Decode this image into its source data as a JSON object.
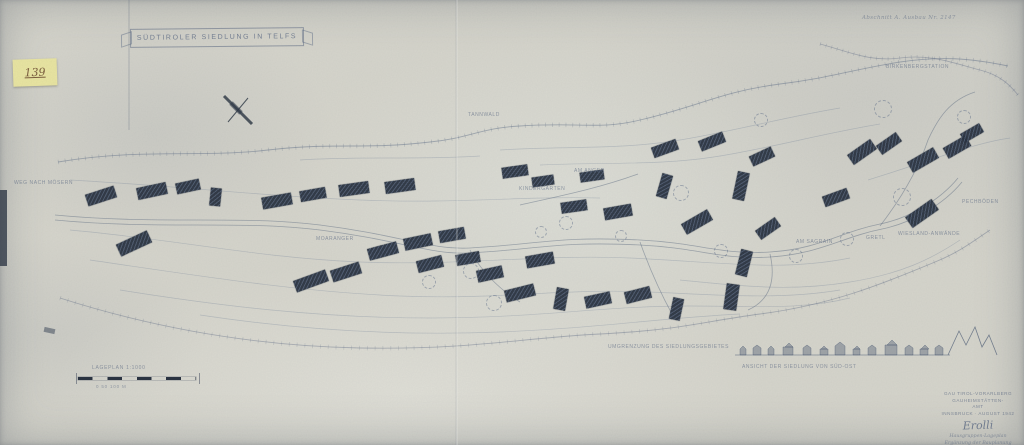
{
  "sheet": {
    "title_banner": "SÜDTIROLER SIEDLUNG IN TELFS",
    "sticker_number": "139",
    "annotation_top_right": "Abschnitt A. Ausbau Nr. 2147"
  },
  "colors": {
    "paper": "#d6d5cc",
    "ink": "#5c6a84",
    "building": "#2b3442",
    "sticker": "#e9e5a2"
  },
  "scale_bar": {
    "label_top": "LAGEPLAN 1:1000",
    "label_bottom": "0   50   100 M"
  },
  "title_block": {
    "lines": [
      "GAU TIROL-VORARLBERG",
      "GAUHEIMSTÄTTEN-",
      "AMT",
      "INNSBRUCK · AUGUST 1942"
    ],
    "signature": "Erolli",
    "sub_lines": [
      "Hausgruppen-Lageplan",
      "Ergänzung der Bauplanung",
      "Maßstab 1:1000"
    ]
  },
  "plan_labels": [
    {
      "t": "WEG NACH MÖSERN",
      "x": 14,
      "y": 180
    },
    {
      "t": "TANNWALD",
      "x": 468,
      "y": 112
    },
    {
      "t": "KINDERGARTEN",
      "x": 519,
      "y": 186
    },
    {
      "t": "AM ANGER",
      "x": 574,
      "y": 168
    },
    {
      "t": "MOARANGER",
      "x": 316,
      "y": 236
    },
    {
      "t": "AM SAGRAIN",
      "x": 796,
      "y": 239
    },
    {
      "t": "GRETL",
      "x": 866,
      "y": 235
    },
    {
      "t": "WIESLAND-ANWÄNDE",
      "x": 898,
      "y": 231
    },
    {
      "t": "PECHBÖDEN",
      "x": 962,
      "y": 199
    },
    {
      "t": "BIRKENBERGSTATION",
      "x": 886,
      "y": 64
    },
    {
      "t": "UMGRENZUNG DES SIEDLUNGSGEBIETES",
      "x": 608,
      "y": 344
    },
    {
      "t": "ANSICHT DER SIEDLUNG VON SÜD-OST",
      "x": 742,
      "y": 364
    }
  ],
  "buildings": [
    [
      101,
      196,
      30,
      12,
      -18
    ],
    [
      152,
      191,
      30,
      12,
      -12
    ],
    [
      188,
      186,
      24,
      11,
      -12
    ],
    [
      215,
      197,
      11,
      18,
      6
    ],
    [
      277,
      201,
      30,
      12,
      -10
    ],
    [
      313,
      194,
      26,
      11,
      -10
    ],
    [
      354,
      189,
      30,
      12,
      -8
    ],
    [
      400,
      186,
      30,
      12,
      -8
    ],
    [
      134,
      243,
      34,
      13,
      -25
    ],
    [
      311,
      281,
      34,
      12,
      -20
    ],
    [
      346,
      272,
      30,
      12,
      -18
    ],
    [
      383,
      251,
      30,
      12,
      -15
    ],
    [
      418,
      242,
      28,
      12,
      -12
    ],
    [
      452,
      235,
      26,
      12,
      -10
    ],
    [
      430,
      264,
      26,
      12,
      -14
    ],
    [
      468,
      258,
      24,
      11,
      -10
    ],
    [
      490,
      274,
      26,
      12,
      -12
    ],
    [
      515,
      171,
      26,
      11,
      -8
    ],
    [
      543,
      181,
      22,
      10,
      -8
    ],
    [
      540,
      260,
      28,
      12,
      -10
    ],
    [
      520,
      293,
      30,
      12,
      -14
    ],
    [
      561,
      299,
      12,
      22,
      10
    ],
    [
      598,
      300,
      26,
      12,
      -12
    ],
    [
      638,
      295,
      26,
      12,
      -14
    ],
    [
      676,
      309,
      11,
      22,
      12
    ],
    [
      731,
      297,
      13,
      26,
      8
    ],
    [
      744,
      263,
      12,
      26,
      14
    ],
    [
      574,
      206,
      26,
      11,
      -8
    ],
    [
      618,
      212,
      28,
      12,
      -10
    ],
    [
      592,
      176,
      24,
      10,
      -8
    ],
    [
      665,
      148,
      26,
      11,
      -20
    ],
    [
      712,
      141,
      26,
      11,
      -22
    ],
    [
      664,
      186,
      11,
      24,
      16
    ],
    [
      697,
      222,
      30,
      12,
      -30
    ],
    [
      741,
      186,
      12,
      28,
      12
    ],
    [
      762,
      156,
      24,
      11,
      -25
    ],
    [
      768,
      228,
      24,
      11,
      -35
    ],
    [
      836,
      197,
      26,
      11,
      -20
    ],
    [
      862,
      152,
      28,
      12,
      -35
    ],
    [
      889,
      143,
      24,
      11,
      -35
    ],
    [
      923,
      160,
      30,
      12,
      -30
    ],
    [
      957,
      147,
      26,
      12,
      -30
    ],
    [
      972,
      133,
      22,
      10,
      -30
    ],
    [
      922,
      213,
      32,
      13,
      -35
    ]
  ],
  "trees": [
    [
      470,
      270,
      7
    ],
    [
      493,
      302,
      7
    ],
    [
      565,
      222,
      6
    ],
    [
      680,
      192,
      7
    ],
    [
      882,
      108,
      8
    ],
    [
      901,
      196,
      8
    ],
    [
      846,
      238,
      6
    ],
    [
      760,
      119,
      6
    ],
    [
      963,
      116,
      6
    ],
    [
      428,
      281,
      6
    ],
    [
      720,
      250,
      6
    ],
    [
      540,
      231,
      5
    ],
    [
      795,
      255,
      6
    ],
    [
      620,
      235,
      5
    ]
  ]
}
